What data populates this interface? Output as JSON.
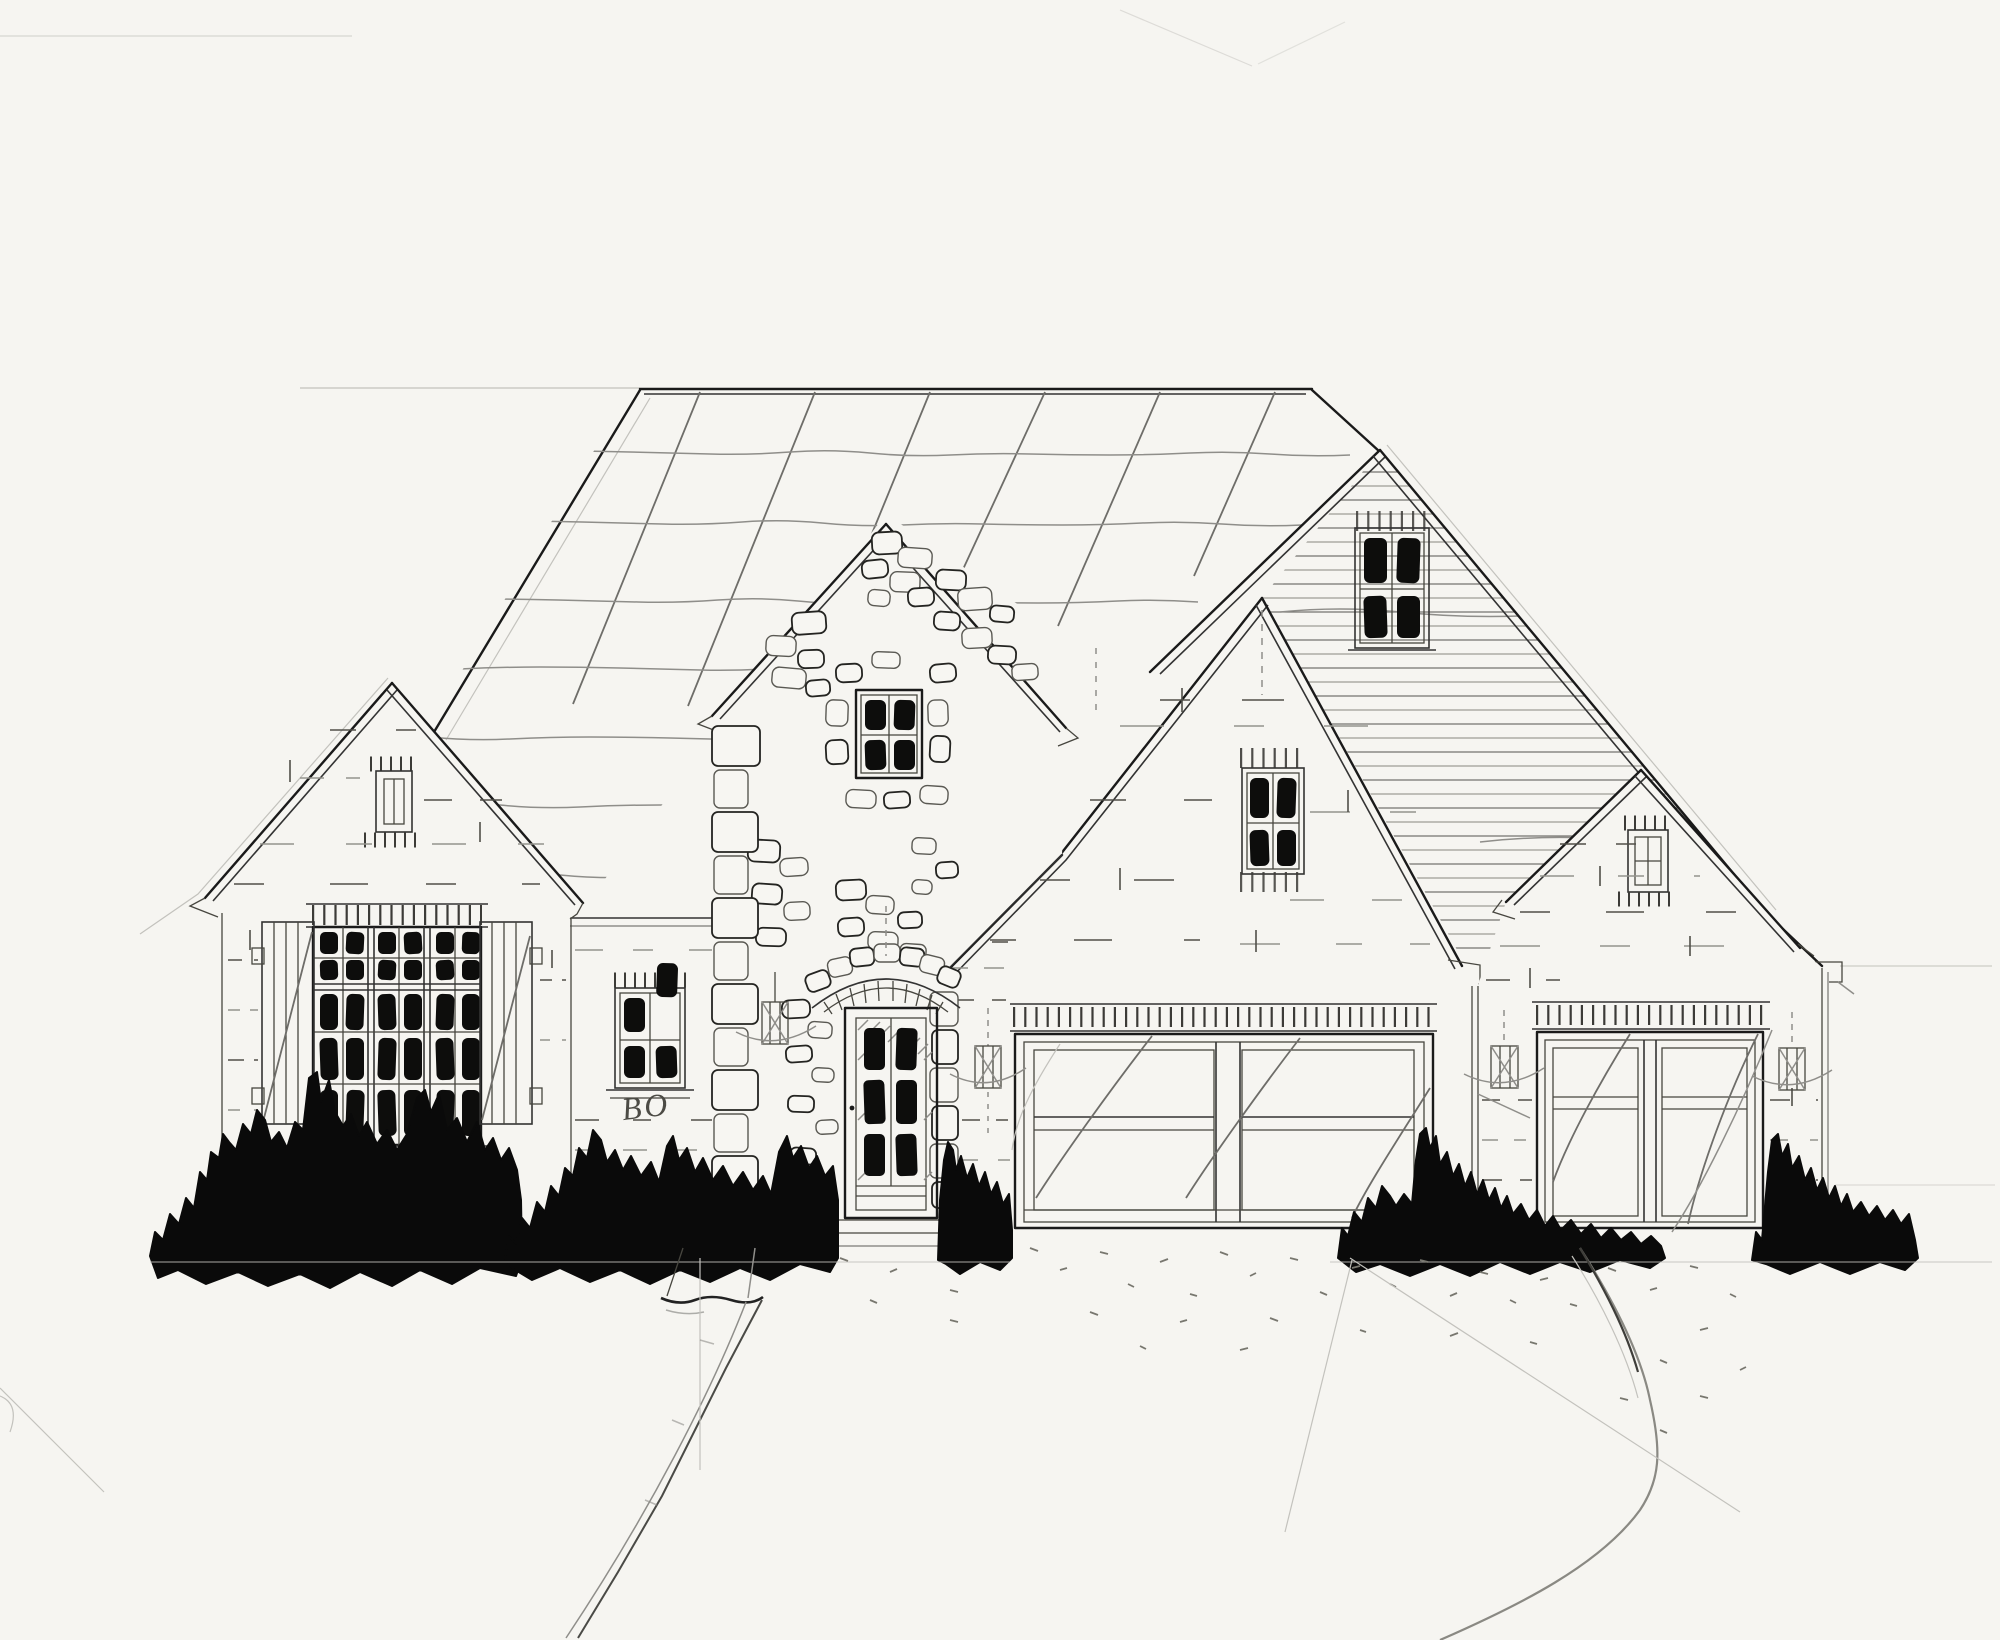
{
  "annotation": {
    "label": "BO"
  },
  "palette": {
    "paper": "#f6f5f1",
    "ink": "#1a1a1a",
    "pencil": "#8f8e8a",
    "pane_black": "#0d0d0c",
    "shrub_black": "#0a0a0a"
  },
  "drawing": {
    "kind": "front elevation sketch of a single-family house",
    "entry_door_lites": "6",
    "left_window_grid": "6 x 5",
    "garage_doors": "double + single"
  }
}
